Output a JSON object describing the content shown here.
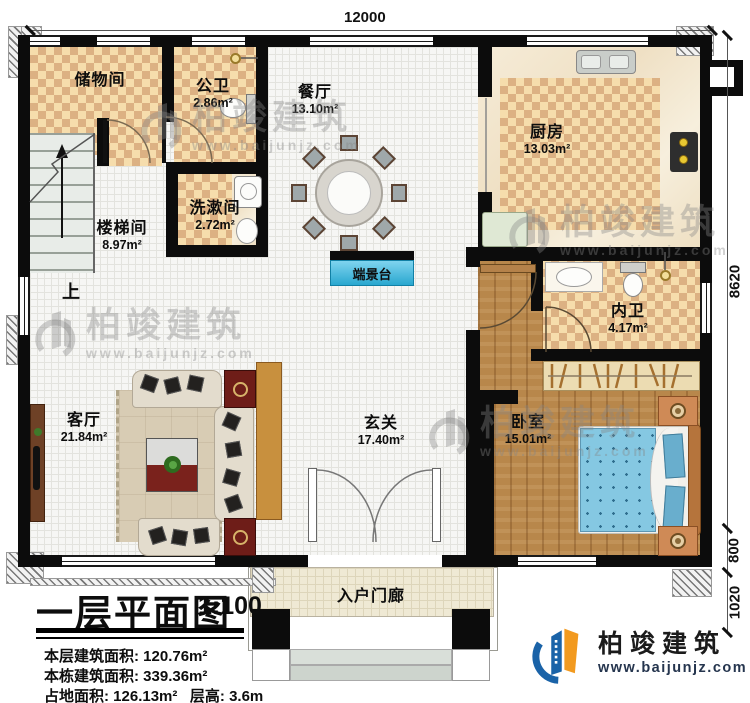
{
  "dimensions": {
    "top": "12000",
    "right": [
      "8620",
      "800",
      "1020"
    ]
  },
  "rooms": {
    "storage": {
      "name": "储物间"
    },
    "public_bath": {
      "name": "公卫",
      "area": "2.86m²"
    },
    "dining": {
      "name": "餐厅",
      "area": "13.10m²"
    },
    "kitchen": {
      "name": "厨房",
      "area": "13.03m²"
    },
    "washroom": {
      "name": "洗漱间",
      "area": "2.72m²"
    },
    "stairwell": {
      "name": "楼梯间",
      "area": "8.97m²",
      "direction": "上"
    },
    "console": {
      "name": "端景台"
    },
    "inner_bath": {
      "name": "内卫",
      "area": "4.17m²"
    },
    "living": {
      "name": "客厅",
      "area": "21.84m²"
    },
    "foyer": {
      "name": "玄关",
      "area": "17.40m²"
    },
    "bedroom": {
      "name": "卧室",
      "area": "15.01m²"
    },
    "porch": {
      "name": "入户门廊"
    }
  },
  "title_block": {
    "title": "一层平面图",
    "scale": "1:100",
    "lines": [
      {
        "label": "本层建筑面积:",
        "value": "120.76m²"
      },
      {
        "label": "本栋建筑面积:",
        "value": "339.36m²"
      },
      {
        "label": "占地面积:",
        "value": "126.13m²",
        "label2": "层高:",
        "value2": "3.6m"
      }
    ]
  },
  "brand": {
    "name": "柏竣建筑",
    "url": "www.baijunjz.com"
  },
  "watermark": {
    "name": "柏竣建筑",
    "url": "www.baijunjz.com"
  },
  "colors": {
    "wall": "#0c0c0c",
    "tile_warm": "#e9c27f",
    "wood": "#b8874b",
    "console_cyan": "#49bfdf",
    "logo_blue": "#1a63a8",
    "logo_orange": "#f29a1f"
  }
}
